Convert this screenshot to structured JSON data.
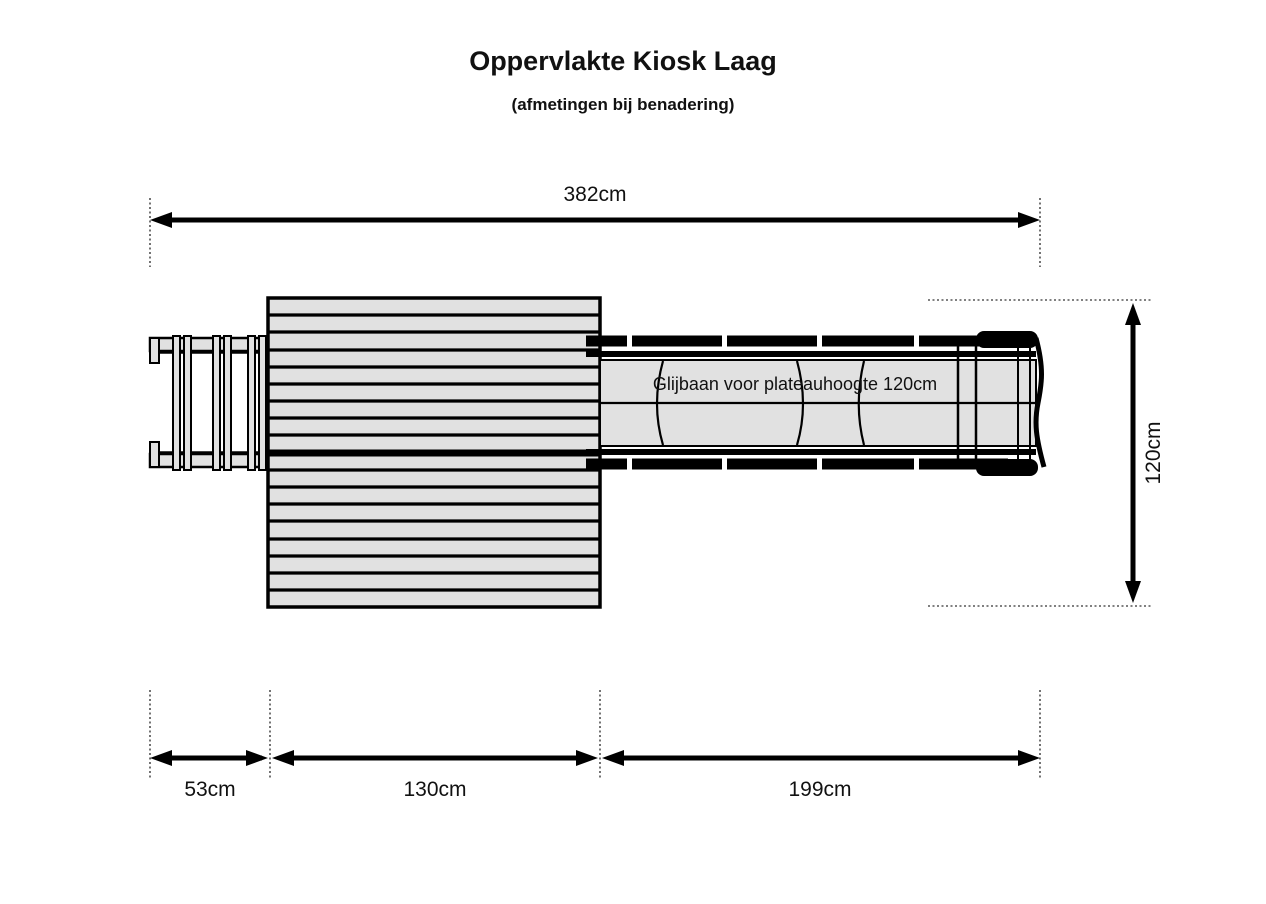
{
  "title": "Oppervlakte Kiosk Laag",
  "subtitle": "(afmetingen bij benadering)",
  "slide": {
    "annotation": "Glijbaan voor plateauhoogte 120cm"
  },
  "dimensions": {
    "total_width": {
      "label": "382cm"
    },
    "depth": {
      "label": "120cm"
    },
    "ladder_width": {
      "label": "53cm"
    },
    "platform_width": {
      "label": "130cm"
    },
    "slide_length": {
      "label": "199cm"
    }
  },
  "colors": {
    "line": "#000000",
    "part_fill": "#e1e1e1",
    "background": "#ffffff"
  }
}
